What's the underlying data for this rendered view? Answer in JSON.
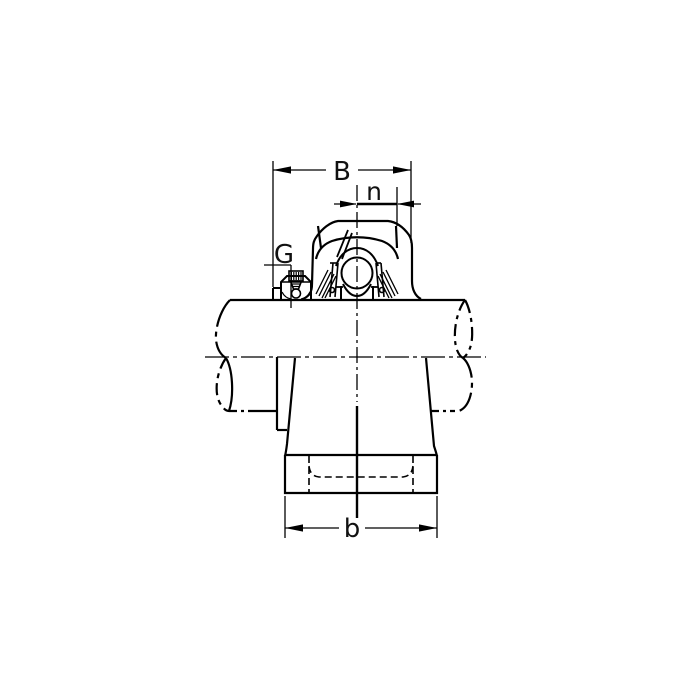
{
  "page": {
    "background": "#ffffff"
  },
  "drawing": {
    "subject": "pillow-block-bearing-unit-side-view-with-shaft",
    "line_color": "#000000",
    "labels": {
      "B": "B",
      "n": "n",
      "G": "G",
      "b": "b"
    }
  }
}
